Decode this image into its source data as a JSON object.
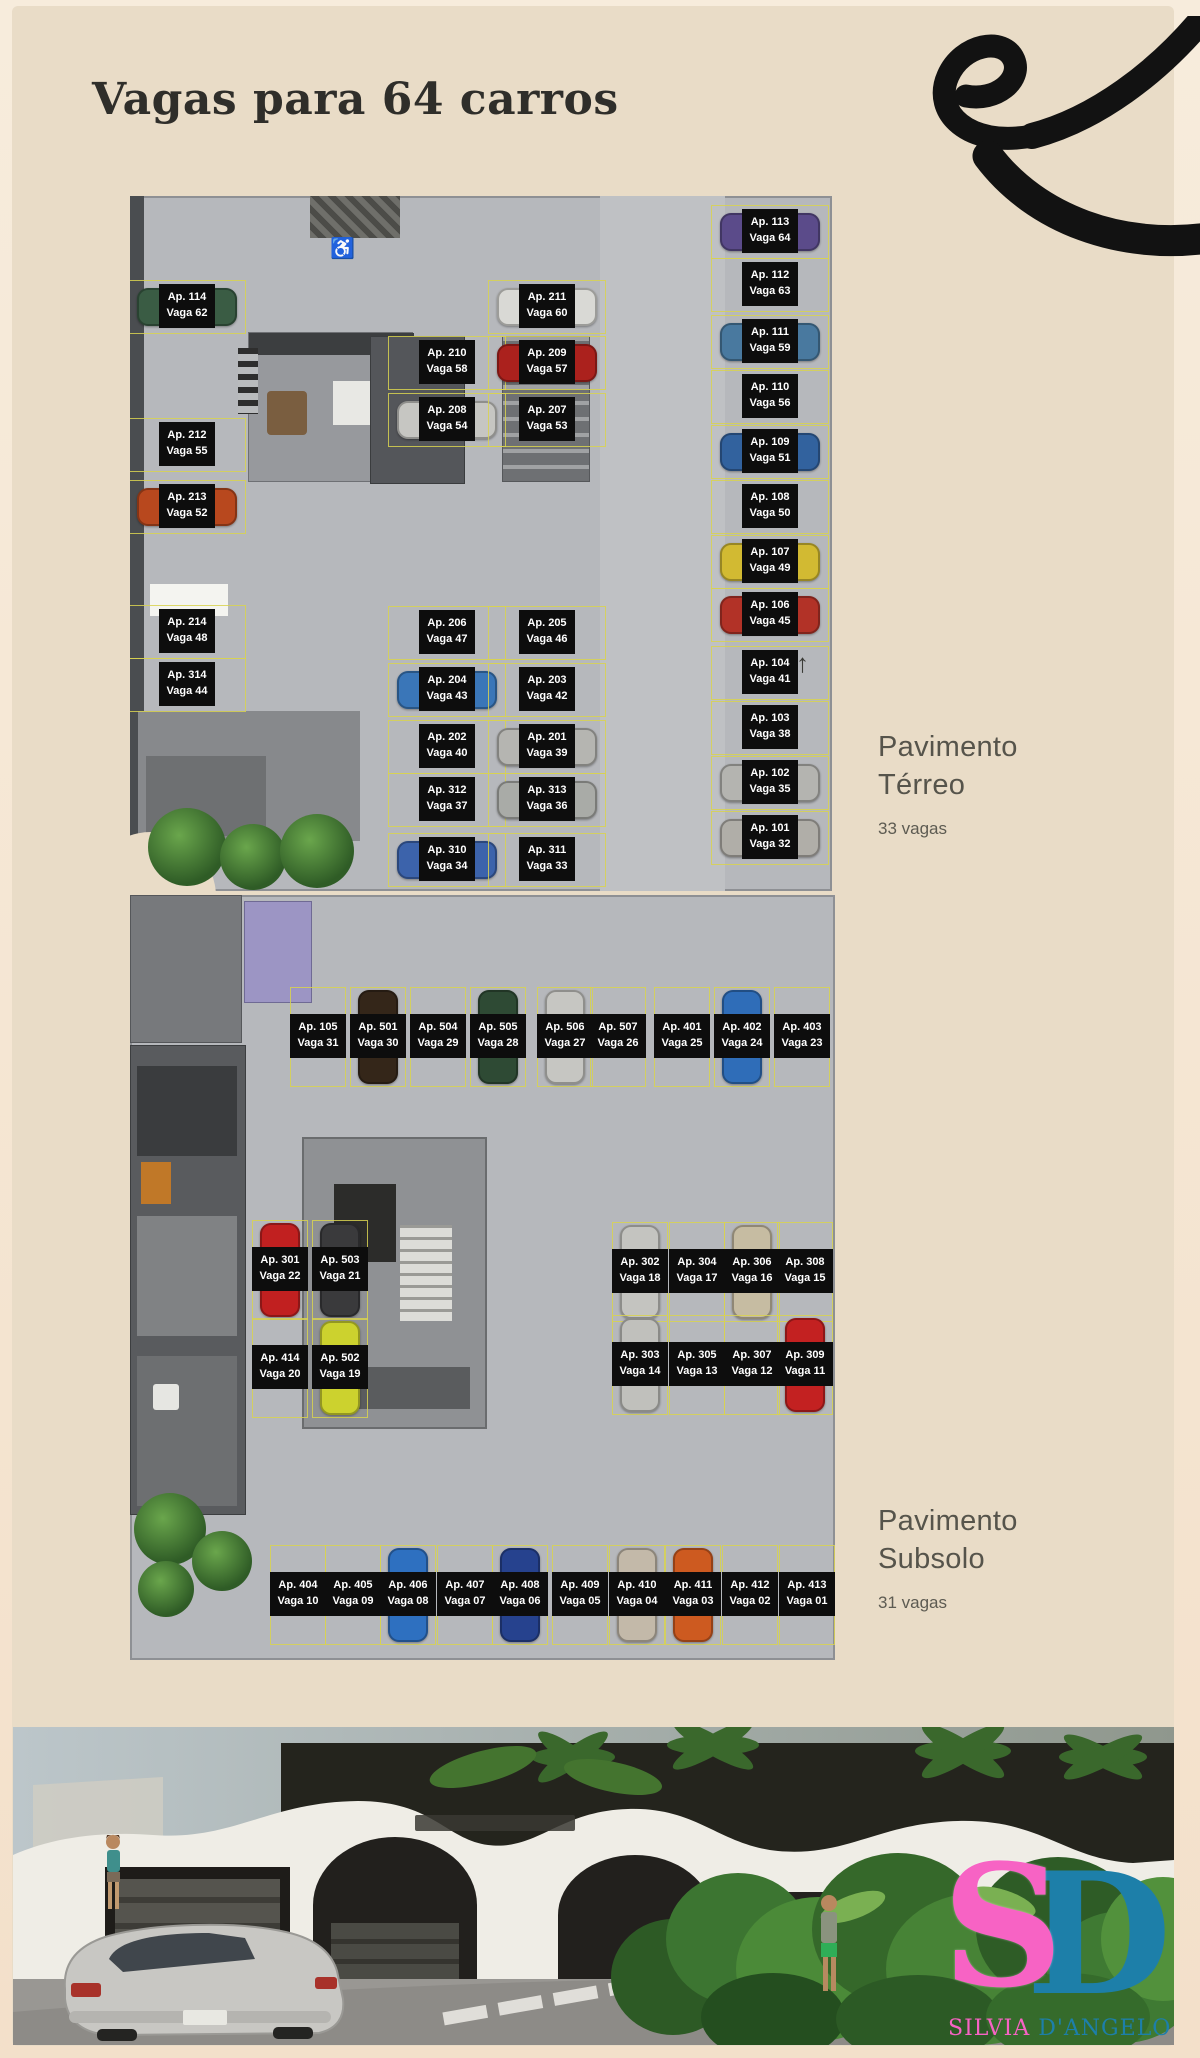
{
  "page": {
    "title": "Vagas para 64 carros"
  },
  "sections": {
    "terreo": {
      "line1": "Pavimento",
      "line2": "Térreo",
      "count": "33 vagas"
    },
    "subsolo": {
      "line1": "Pavimento",
      "line2": "Subsolo",
      "count": "31 vagas"
    }
  },
  "icons": {
    "accessible": "♿",
    "north_arrow": "↑"
  },
  "brand": {
    "monogram_s": "S",
    "monogram_d": "D",
    "name_pink": "SILVIA",
    "name_teal": "D'ANGELO",
    "pink": "#f763c4",
    "teal": "#1d7fa9"
  },
  "plans": {
    "terreo": {
      "spots": [
        {
          "ap": "Ap. 114",
          "vaga": "Vaga 62",
          "x": 57,
          "y": 111,
          "car": "#3a5c44"
        },
        {
          "ap": "Ap. 212",
          "vaga": "Vaga 55",
          "x": 57,
          "y": 249,
          "car": null
        },
        {
          "ap": "Ap. 213",
          "vaga": "Vaga 52",
          "x": 57,
          "y": 311,
          "car": "#b8481e"
        },
        {
          "ap": "Ap. 214",
          "vaga": "Vaga 48",
          "x": 57,
          "y": 436,
          "car": null
        },
        {
          "ap": "Ap. 314",
          "vaga": "Vaga 44",
          "x": 57,
          "y": 489,
          "car": null
        },
        {
          "ap": "Ap. 211",
          "vaga": "Vaga 60",
          "x": 417,
          "y": 111,
          "car": "#d9d9d5"
        },
        {
          "ap": "Ap. 210",
          "vaga": "Vaga 58",
          "x": 317,
          "y": 167,
          "car": null
        },
        {
          "ap": "Ap. 209",
          "vaga": "Vaga 57",
          "x": 417,
          "y": 167,
          "car": "#ab211d"
        },
        {
          "ap": "Ap. 208",
          "vaga": "Vaga 54",
          "x": 317,
          "y": 224,
          "car": "#c6c6c2"
        },
        {
          "ap": "Ap. 207",
          "vaga": "Vaga 53",
          "x": 417,
          "y": 224,
          "car": null
        },
        {
          "ap": "Ap. 206",
          "vaga": "Vaga 47",
          "x": 317,
          "y": 437,
          "car": null
        },
        {
          "ap": "Ap. 205",
          "vaga": "Vaga 46",
          "x": 417,
          "y": 437,
          "car": null
        },
        {
          "ap": "Ap. 204",
          "vaga": "Vaga 43",
          "x": 317,
          "y": 494,
          "car": "#3a76b8"
        },
        {
          "ap": "Ap. 203",
          "vaga": "Vaga 42",
          "x": 417,
          "y": 494,
          "car": null
        },
        {
          "ap": "Ap. 202",
          "vaga": "Vaga 40",
          "x": 317,
          "y": 551,
          "car": null
        },
        {
          "ap": "Ap. 201",
          "vaga": "Vaga 39",
          "x": 417,
          "y": 551,
          "car": "#b5b5b1"
        },
        {
          "ap": "Ap. 312",
          "vaga": "Vaga 37",
          "x": 317,
          "y": 604,
          "car": null
        },
        {
          "ap": "Ap. 313",
          "vaga": "Vaga 36",
          "x": 417,
          "y": 604,
          "car": "#a9aba7"
        },
        {
          "ap": "Ap. 310",
          "vaga": "Vaga 34",
          "x": 317,
          "y": 664,
          "car": "#3c63ab"
        },
        {
          "ap": "Ap. 311",
          "vaga": "Vaga 33",
          "x": 417,
          "y": 664,
          "car": null
        },
        {
          "ap": "Ap. 113",
          "vaga": "Vaga 64",
          "x": 640,
          "y": 36,
          "car": "#5b4b8a"
        },
        {
          "ap": "Ap. 112",
          "vaga": "Vaga 63",
          "x": 640,
          "y": 89,
          "car": null
        },
        {
          "ap": "Ap. 111",
          "vaga": "Vaga 59",
          "x": 640,
          "y": 146,
          "car": "#49799f"
        },
        {
          "ap": "Ap. 110",
          "vaga": "Vaga 56",
          "x": 640,
          "y": 201,
          "car": null
        },
        {
          "ap": "Ap. 109",
          "vaga": "Vaga 51",
          "x": 640,
          "y": 256,
          "car": "#32629e"
        },
        {
          "ap": "Ap. 108",
          "vaga": "Vaga 50",
          "x": 640,
          "y": 311,
          "car": null
        },
        {
          "ap": "Ap. 107",
          "vaga": "Vaga 49",
          "x": 640,
          "y": 366,
          "car": "#d2ba32"
        },
        {
          "ap": "Ap. 106",
          "vaga": "Vaga 45",
          "x": 640,
          "y": 419,
          "car": "#b23227"
        },
        {
          "ap": "Ap. 104",
          "vaga": "Vaga 41",
          "x": 640,
          "y": 477,
          "car": null
        },
        {
          "ap": "Ap. 103",
          "vaga": "Vaga 38",
          "x": 640,
          "y": 532,
          "car": null
        },
        {
          "ap": "Ap. 102",
          "vaga": "Vaga 35",
          "x": 640,
          "y": 587,
          "car": "#b4b4b0"
        },
        {
          "ap": "Ap. 101",
          "vaga": "Vaga 32",
          "x": 640,
          "y": 642,
          "car": "#b0aea8"
        }
      ]
    },
    "subsolo": {
      "spots": [
        {
          "ap": "Ap. 105",
          "vaga": "Vaga 31",
          "x": 188,
          "y": 142,
          "car": null
        },
        {
          "ap": "Ap. 501",
          "vaga": "Vaga 30",
          "x": 248,
          "y": 142,
          "car": "#342619"
        },
        {
          "ap": "Ap. 504",
          "vaga": "Vaga 29",
          "x": 308,
          "y": 142,
          "car": null
        },
        {
          "ap": "Ap. 505",
          "vaga": "Vaga 28",
          "x": 368,
          "y": 142,
          "car": "#2e4a34"
        },
        {
          "ap": "Ap. 506",
          "vaga": "Vaga 27",
          "x": 435,
          "y": 142,
          "car": "#c6c6c2"
        },
        {
          "ap": "Ap. 507",
          "vaga": "Vaga 26",
          "x": 488,
          "y": 142,
          "car": null
        },
        {
          "ap": "Ap. 401",
          "vaga": "Vaga 25",
          "x": 552,
          "y": 142,
          "car": null
        },
        {
          "ap": "Ap. 402",
          "vaga": "Vaga 24",
          "x": 612,
          "y": 142,
          "car": "#2f6db8"
        },
        {
          "ap": "Ap. 403",
          "vaga": "Vaga 23",
          "x": 672,
          "y": 142,
          "car": null
        },
        {
          "ap": "Ap. 301",
          "vaga": "Vaga 22",
          "x": 150,
          "y": 375,
          "car": "#c12020"
        },
        {
          "ap": "Ap. 503",
          "vaga": "Vaga 21",
          "x": 210,
          "y": 375,
          "car": "#3a3a3c"
        },
        {
          "ap": "Ap. 414",
          "vaga": "Vaga 20",
          "x": 150,
          "y": 473,
          "car": null
        },
        {
          "ap": "Ap. 502",
          "vaga": "Vaga 19",
          "x": 210,
          "y": 473,
          "car": "#ccd22e"
        },
        {
          "ap": "Ap. 302",
          "vaga": "Vaga 18",
          "x": 510,
          "y": 377,
          "car": "#c4c4c0"
        },
        {
          "ap": "Ap. 304",
          "vaga": "Vaga 17",
          "x": 567,
          "y": 377,
          "car": null
        },
        {
          "ap": "Ap. 306",
          "vaga": "Vaga 16",
          "x": 622,
          "y": 377,
          "car": "#c6bca2"
        },
        {
          "ap": "Ap. 308",
          "vaga": "Vaga 15",
          "x": 675,
          "y": 377,
          "car": null
        },
        {
          "ap": "Ap. 303",
          "vaga": "Vaga 14",
          "x": 510,
          "y": 470,
          "car": "#c0c0bc"
        },
        {
          "ap": "Ap. 305",
          "vaga": "Vaga 13",
          "x": 567,
          "y": 470,
          "car": null
        },
        {
          "ap": "Ap. 307",
          "vaga": "Vaga 12",
          "x": 622,
          "y": 470,
          "car": null
        },
        {
          "ap": "Ap. 309",
          "vaga": "Vaga 11",
          "x": 675,
          "y": 470,
          "car": "#c32121"
        },
        {
          "ap": "Ap. 404",
          "vaga": "Vaga 10",
          "x": 168,
          "y": 700,
          "car": null
        },
        {
          "ap": "Ap. 405",
          "vaga": "Vaga 09",
          "x": 223,
          "y": 700,
          "car": null
        },
        {
          "ap": "Ap. 406",
          "vaga": "Vaga 08",
          "x": 278,
          "y": 700,
          "car": "#2e70c0"
        },
        {
          "ap": "Ap. 407",
          "vaga": "Vaga 07",
          "x": 335,
          "y": 700,
          "car": null
        },
        {
          "ap": "Ap. 408",
          "vaga": "Vaga 06",
          "x": 390,
          "y": 700,
          "car": "#26428e"
        },
        {
          "ap": "Ap. 409",
          "vaga": "Vaga 05",
          "x": 450,
          "y": 700,
          "car": null
        },
        {
          "ap": "Ap. 410",
          "vaga": "Vaga 04",
          "x": 507,
          "y": 700,
          "car": "#c3b9a9"
        },
        {
          "ap": "Ap. 411",
          "vaga": "Vaga 03",
          "x": 563,
          "y": 700,
          "car": "#cd5a20"
        },
        {
          "ap": "Ap. 412",
          "vaga": "Vaga 02",
          "x": 620,
          "y": 700,
          "car": null
        },
        {
          "ap": "Ap. 413",
          "vaga": "Vaga 01",
          "x": 677,
          "y": 700,
          "car": null
        }
      ]
    }
  }
}
